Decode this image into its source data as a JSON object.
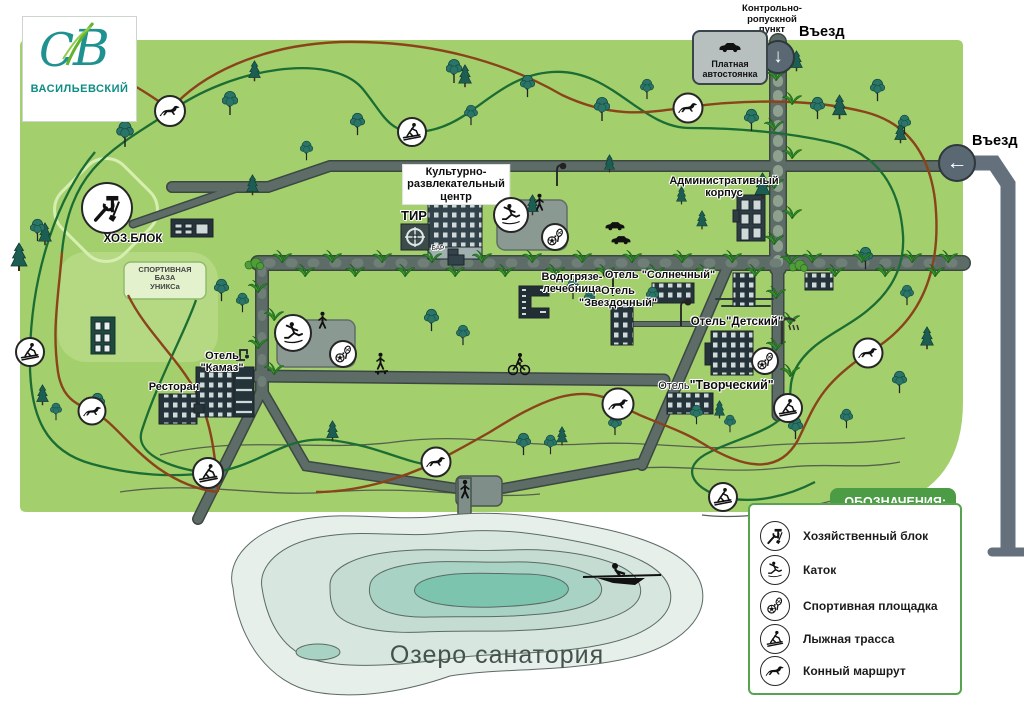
{
  "logo": {
    "monogram_c": "С",
    "monogram_v": "В",
    "name": "ВАСИЛЬЕВСКИЙ"
  },
  "entrances": {
    "top_checkpoint": [
      "Контрольно-",
      "ропускной",
      "пункт"
    ],
    "top_entry": "Въезд",
    "top_arrow": "↓",
    "right_entry": "Въезд",
    "right_arrow": "←",
    "parking": [
      "Платная",
      "автостоянка"
    ]
  },
  "places": {
    "krc": [
      "Культурно-",
      "развлекательный",
      "центр"
    ],
    "tir": "ТИР",
    "bar": "БАР",
    "admin": [
      "Административный",
      "корпус"
    ],
    "hozblok": "ХОЗ.БЛОК",
    "sportbase": [
      "СПОРТИВНАЯ",
      "БАЗА",
      "УНИКСа"
    ],
    "vodo": [
      "Водогрязе-",
      "лечебница"
    ],
    "hotel_sunny": "Отель \"Солнечный\"",
    "hotel_star": [
      "Отель",
      "\"Звездочный\""
    ],
    "hotel_kids": "Отель\"Детский\"",
    "hotel_kamaz": [
      "Отель",
      "\"Камаз\""
    ],
    "hotel_creative_prefix": "Отель",
    "hotel_creative_name": "\"Творческий\"",
    "restaurant": "Ресторан",
    "lake": "Озеро  санатория"
  },
  "legend": {
    "title": "ОБОЗНАЧЕНИЯ:",
    "items": [
      {
        "icon": "tools-icon",
        "label": "Хозяйственный блок"
      },
      {
        "icon": "skater-icon",
        "label": "Каток"
      },
      {
        "icon": "sport-icon",
        "label": "Спортивная площадка"
      },
      {
        "icon": "ski-icon",
        "label": "Лыжная трасса"
      },
      {
        "icon": "horse-icon",
        "label": "Конный маршрут"
      }
    ]
  },
  "colors": {
    "map_green": "#a4cf6d",
    "road_gray": "#5d6c66",
    "ski_trail": "#1b6d33",
    "horse_trail": "#8a431a",
    "legend_green": "#4c9b45",
    "lake_core": "#7cc4ae",
    "logo_teal": "#1f9191"
  }
}
